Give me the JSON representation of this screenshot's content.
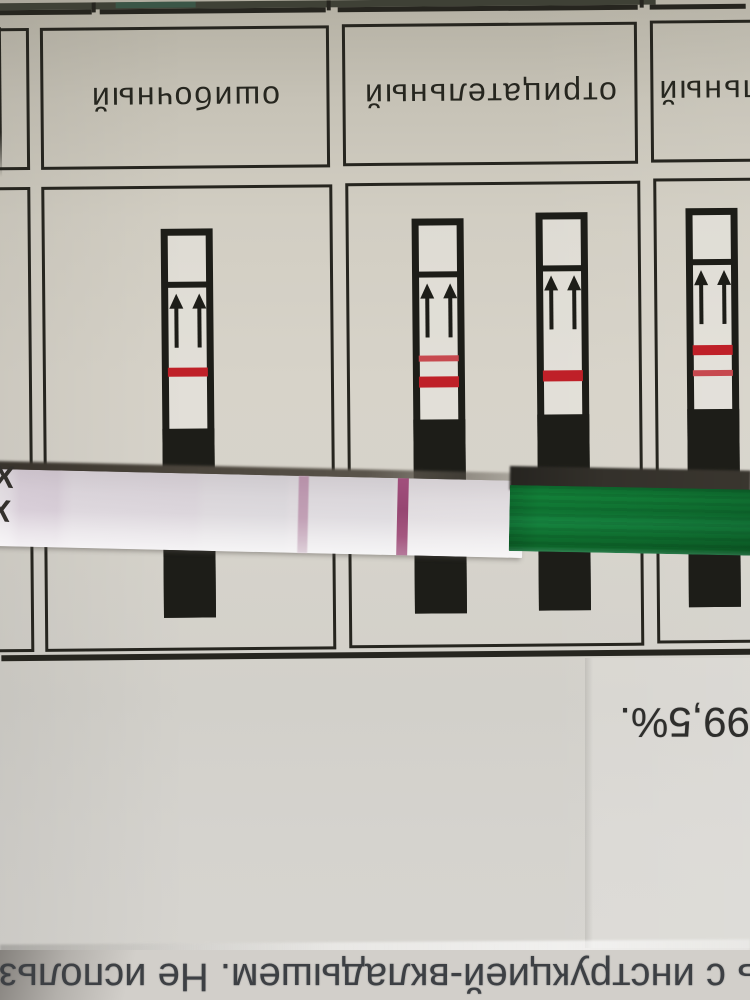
{
  "leaflet": {
    "table": {
      "columns": [
        {
          "id": "erroneous",
          "label": "ошибочный",
          "strips": [
            {
              "lines": [
                {
                  "thickness": "thick",
                  "color": "#bf2028"
                }
              ]
            }
          ]
        },
        {
          "id": "negative",
          "label": "отрицательный",
          "strips": [
            {
              "lines": [
                {
                  "thickness": "thin",
                  "color": "#c7494f"
                },
                {
                  "thickness": "thick",
                  "color": "#bf2028"
                }
              ]
            },
            {
              "lines": [
                {
                  "thickness": "thick",
                  "color": "#bf2028"
                }
              ]
            }
          ]
        },
        {
          "id": "positive-partial",
          "label": "льный",
          "strips": [
            {
              "lines": [
                {
                  "thickness": "thick",
                  "color": "#bf2028"
                },
                {
                  "thickness": "thin",
                  "color": "#c7494f"
                }
              ]
            }
          ]
        }
      ],
      "border_color": "#26251f",
      "diagram_line_thick_color": "#bf2028",
      "diagram_line_thin_color": "#c7494f"
    },
    "percent_text": "99,5%.",
    "bottom_line_text": "ь с инструкцией-вкладышем. Не использова",
    "text_rotation": "180deg (leaflet is upside down)"
  },
  "test_strip": {
    "marks": [
      "X",
      "X"
    ],
    "faint_line_color": "#b183a0",
    "strong_line_color": "#964672",
    "handle_color": "#128038",
    "body_color": "#dcd6dc"
  }
}
